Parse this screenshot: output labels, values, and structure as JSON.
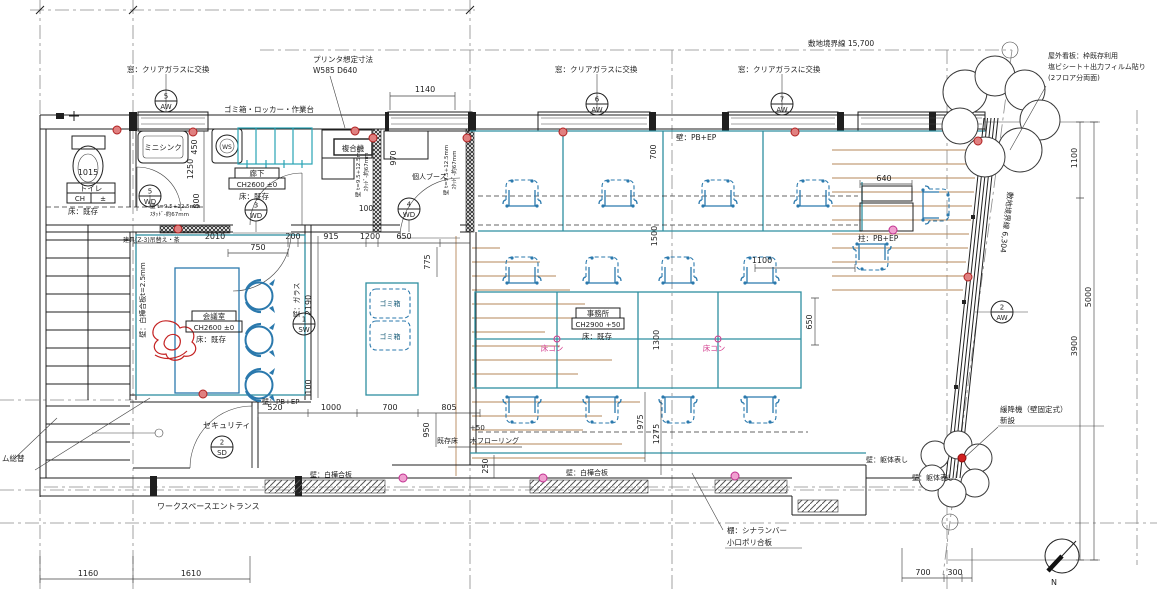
{
  "labels": {
    "window_note": "窓：クリアガラスに交換",
    "printer_1": "プリンタ想定寸法",
    "printer_2": "W585 D640",
    "bins_locker": "ゴミ箱・ロッカー・作業台",
    "sign_1": "屋外看板：枠既存利用",
    "sign_2": "塩ビシート＋出力フィルム貼り",
    "sign_3": "(2フロア分両面)",
    "boundary_top": "敷地境界線 15,700",
    "boundary_right": "敷地境界線 6,304",
    "mini_sink": "ミニシンク",
    "mfp": "複合機",
    "booth": "個人ブース",
    "toilet": "トイレ",
    "ch_blank": "CH",
    "pm": "±",
    "floor_existing": "床：既存",
    "corridor": "廊下",
    "ch2600": "CH2600 ±0",
    "meeting": "会議室",
    "office": "事務所",
    "ch2900": "CH2900 +50",
    "floor_con": "床コン",
    "trash": "ゴミ箱",
    "security": "セキュリティ",
    "entrance": "ワークスペースエントランス",
    "wall_pbep": "壁：PB+EP",
    "col_pbep": "柱：PB+EP",
    "wall_glass": "壁：ガラス",
    "wall_birch25": "壁：白樺合板t=2.5mm",
    "wall_birch": "壁：白樺合板",
    "wall_kutai": "壁：躯体表し",
    "spec_1": "壁 t=9.5+12.5mm",
    "spec_2": "ｽﾀｯﾄﾞ-約67mm",
    "shelf_1": "棚：シナランバー",
    "shelf_2": "小口ポリ合板",
    "esc_1": "緩降機（壁固定式）",
    "esc_2": "新設",
    "exist_floor": "既存床",
    "wood_floor": "木フローリング",
    "door_note": "建具(Z-3)吊替え・茶",
    "left_partial": "ム総替",
    "north": "N"
  },
  "dims": {
    "d100": "100",
    "d200": "200",
    "d250": "250",
    "d300": "300",
    "d450": "450",
    "d520": "520",
    "d640": "640",
    "d650": "650",
    "d700": "700",
    "d750": "750",
    "d775": "775",
    "d800": "800",
    "d805": "805",
    "d915": "915",
    "d950": "950",
    "d970": "970",
    "d975": "975",
    "d1000": "1000",
    "d1015": "1015",
    "d1100": "1100",
    "d1140": "1140",
    "d1160": "1160",
    "d1200": "1200",
    "d1250": "1250",
    "d1275": "1275",
    "d1300": "1300",
    "d1500": "1500",
    "d1610": "1610",
    "d2010": "2010",
    "d2190": "2190",
    "d3900": "3900",
    "d5000": "5000",
    "plus50": "+50"
  },
  "tags": {
    "aw5": {
      "num": "5",
      "code": "AW"
    },
    "aw6": {
      "num": "6",
      "code": "AW"
    },
    "aw7": {
      "num": "7",
      "code": "AW"
    },
    "aw2": {
      "num": "2",
      "code": "AW"
    },
    "wd5": {
      "num": "5",
      "code": "WD"
    },
    "wd3": {
      "num": "3",
      "code": "WD"
    },
    "wd4": {
      "num": "4",
      "code": "WD"
    },
    "sw1": {
      "num": "1",
      "code": "SW"
    },
    "sd2": {
      "num": "2",
      "code": "SD"
    },
    "ws": {
      "code": "WS"
    }
  },
  "colors": {
    "furniture_blue": "#2b79ad",
    "interior_teal": "#2e8fa0",
    "locker_cyan": "#29a3b5",
    "floor_tan": "#b5875a",
    "marker_red": "#b02020",
    "marker_pink": "#c03090",
    "sketch_red": "#c42222"
  }
}
